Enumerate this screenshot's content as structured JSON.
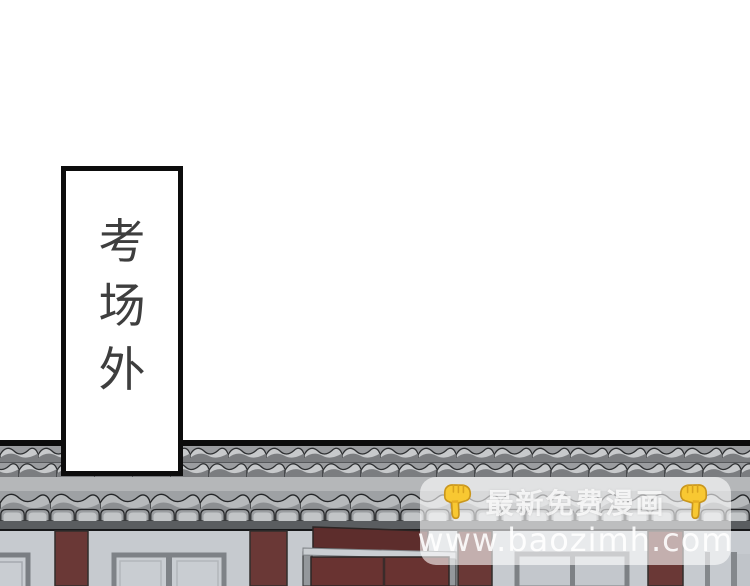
{
  "sign": {
    "text": "考场外",
    "chars": [
      "考",
      "场",
      "外"
    ]
  },
  "watermark": {
    "promo": "最新免费漫画",
    "url": "www.baozimh.com",
    "finger_icon": "backhand-index-pointing-down",
    "finger_color": "#f8c832"
  },
  "palette": {
    "background": "#ffffff",
    "roof_line": "#0c0c0c",
    "ridge_bg": "#9b9da0",
    "tile_light": "#c7c9cb",
    "tile_dark": "#7b7d80",
    "light_band": "#b5b7b9",
    "eave_band": "#5a5d60",
    "wall": "#c6cacf",
    "pillar": "#6a3836",
    "door": "#693331",
    "door_sign_board": "#5d2d2c",
    "window_frame": "#7e8287",
    "sign_border": "#0d0d0d",
    "sign_text": "#3e3e3e"
  }
}
